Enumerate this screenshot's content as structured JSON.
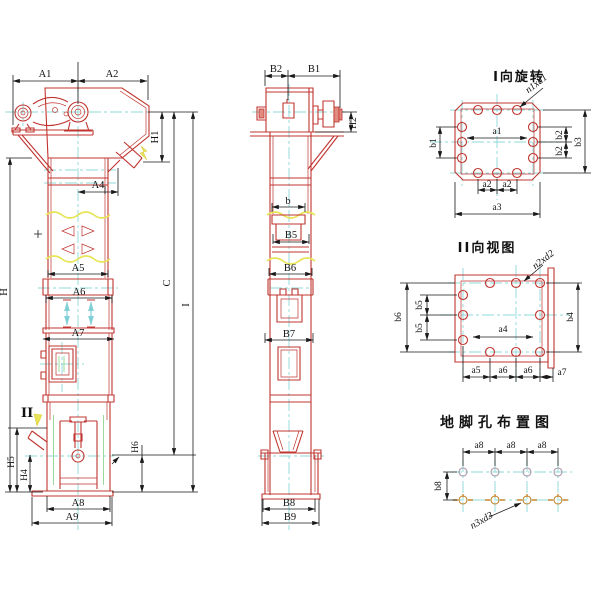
{
  "drawing": {
    "front": {
      "A1": "A1",
      "A2": "A2",
      "A4": "A4",
      "A5": "A5",
      "A6": "A6",
      "A7": "A7",
      "A8": "A8",
      "A9": "A9",
      "H": "H",
      "H1": "H1",
      "H4": "H4",
      "H5": "H5",
      "H6": "H6",
      "C": "C",
      "I": "I",
      "section_marker": "II"
    },
    "side": {
      "B1": "B1",
      "B2": "B2",
      "H2": "H2",
      "b": "b",
      "B5": "B5",
      "B6": "B6",
      "B7": "B7",
      "B8": "B8",
      "B9": "B9"
    },
    "view1": {
      "title": "I向旋转",
      "leader": "n1xd1",
      "a1": "a1",
      "a2": "a2",
      "a3": "a3",
      "b1": "b1",
      "b2": "b2",
      "b3": "b3"
    },
    "view2": {
      "title": "II向视图",
      "leader": "n2xd2",
      "a4": "a4",
      "a5": "a5",
      "a6": "a6",
      "a7": "a7",
      "b4": "b4",
      "b5": "b5",
      "b6": "b6"
    },
    "anchor": {
      "title": "地脚孔布置图",
      "leader": "n3xd3",
      "a8": "a8",
      "b8": "b8"
    },
    "colors": {
      "part_line": "#c03530",
      "dim_line": "#1a1a1a",
      "centerline": "#8fd8d8",
      "break_line": "#e8e455",
      "detail_green": "#9cd89c",
      "anchor_hole": "#c8862f",
      "hole_gray": "#a898a8",
      "background": "#ffffff"
    }
  }
}
